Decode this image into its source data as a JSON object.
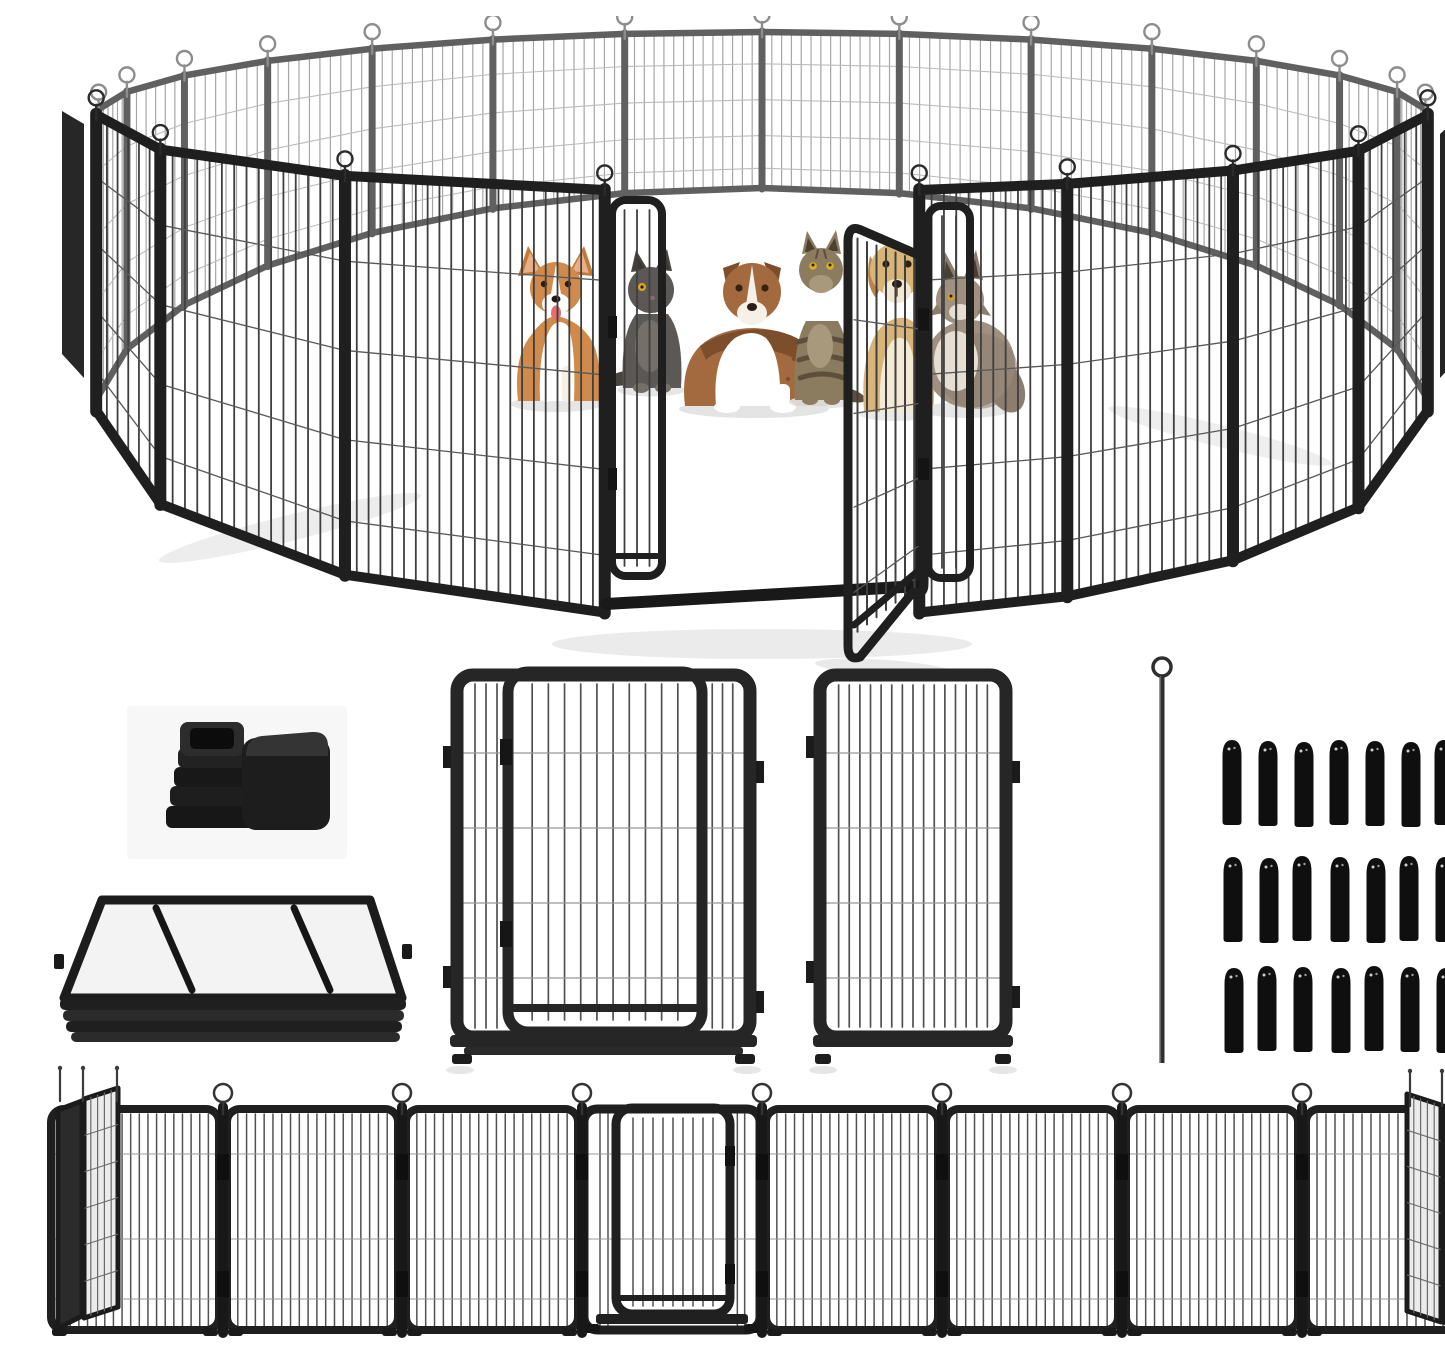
{
  "meta": {
    "title": "Heavy-duty black metal pet playpen kit product photo",
    "description": "Circular arrangement of wire fence panels with open double gate containing two dogs and cats; below: plastic corner caps, folded panel stack, gate panel, plain panel, ground anchor rod, 21 rubber foot caps, and an unfolded row of panels.",
    "background": "#ffffff",
    "canvas": {
      "width": 1445,
      "height": 1323
    }
  },
  "palette": {
    "front_frame": "#1f1f1f",
    "front_wire": "#3f3f3f",
    "front_hwire": "#585858",
    "front_pin": "#2b2b2b",
    "back_frame": "#606060",
    "back_wire": "#a6a6a6",
    "back_hwire": "#bcbcbc",
    "back_pin": "#8d8d8d",
    "part_frame": "#262626",
    "part_wire": "#515151",
    "part_hwire": "#989898",
    "rubber": "#0f0f0f",
    "shadow": "#e3e3e3",
    "card": "#f7f7f7",
    "side_fill_left": "#272727",
    "side_fill_right": "#242424",
    "angled_light_fill": "#ebebeb",
    "angled_dark_fill": "#2b2b2b",
    "grid_line": "#6a6a6a"
  },
  "hero": {
    "ring": {
      "cx": 722,
      "rx": 665,
      "rxDepth": 35,
      "topC": 92,
      "topA": 80,
      "botC": 390,
      "botA": 215,
      "hFr": [
        0.22,
        0.44,
        0.66,
        0.86
      ],
      "backFrom": 92,
      "backTo": 268,
      "backPanels": 14,
      "frontLeft": [
        -88,
        -62,
        -37,
        -13
      ],
      "frontRight": [
        13,
        26,
        43,
        61,
        88
      ],
      "edgeQuadLeft": [
        [
          22,
          95
        ],
        [
          44,
          108
        ],
        [
          44,
          362
        ],
        [
          22,
          338
        ]
      ],
      "edgeQuadRight": [
        [
          1400,
          118
        ],
        [
          1422,
          98
        ],
        [
          1422,
          338
        ],
        [
          1400,
          362
        ]
      ]
    },
    "gate": {
      "leftLeaf": {
        "x1": 572,
        "x2": 622,
        "yT": 184,
        "yB": 560,
        "bars": 3
      },
      "jamb": {
        "x1": 888,
        "x2": 930,
        "yT": 190,
        "yB": 562,
        "bars": 2
      },
      "threshold": {
        "x1": 566,
        "y1": 588,
        "x2": 880,
        "y2": 570,
        "w": 12
      },
      "door": {
        "fx": 808,
        "fyT": 210,
        "fyB": 636,
        "hx": 884,
        "hyT": 238,
        "hyB": 578,
        "bars": 7
      }
    },
    "groundShadows": [
      {
        "cx": 250,
        "cy": 512,
        "rx": 135,
        "ry": 13,
        "rot": -14,
        "o": 0.65
      },
      {
        "cx": 722,
        "cy": 628,
        "rx": 210,
        "ry": 15,
        "rot": 0,
        "o": 0.7
      },
      {
        "cx": 1180,
        "cy": 420,
        "rx": 115,
        "ry": 11,
        "rot": 14,
        "o": 0.6
      },
      {
        "cx": 845,
        "cy": 652,
        "rx": 70,
        "ry": 8,
        "rot": 4,
        "o": 0.8
      }
    ]
  },
  "animals": [
    {
      "id": "corgi",
      "label": "corgi dog sitting",
      "cx": 517,
      "baseY": 388,
      "colors": {
        "coat": "#cf8a4c",
        "coatDark": "#c07a3a",
        "earInner": "#e8b088",
        "white": "#ffffff",
        "tongue": "#e4706e",
        "eye": "#2b1d12"
      }
    },
    {
      "id": "gray_cat",
      "label": "gray cat sitting",
      "cx": 611,
      "baseY": 374,
      "colors": {
        "coat": "#5c5855",
        "coatDark": "#48443f",
        "chest": "#747069",
        "eye": "#dfa71f",
        "earInner": "#3b3734"
      }
    },
    {
      "id": "aussie",
      "label": "australian shepherd lying",
      "cx": 714,
      "baseY": 393,
      "colors": {
        "coat": "#a26a3e",
        "coatDark": "#7c4e2c",
        "white": "#ffffff",
        "muzzle": "#f6f0e7",
        "eye": "#35230f"
      }
    },
    {
      "id": "tabby_cat",
      "label": "tabby cat looking up",
      "cx": 782,
      "baseY": 386,
      "colors": {
        "coat": "#8c7c5f",
        "stripe": "#5d4f3c",
        "chest": "#a8997c",
        "eye": "#d8b01f",
        "earInner": "#4e4030"
      }
    },
    {
      "id": "golden_dog",
      "label": "golden dog behind gate",
      "cx": 857,
      "baseY": 398,
      "colors": {
        "coat": "#d9b478",
        "ear": "#b9854b",
        "chest": "#f3e9d4",
        "muzzle": "#f2e7d2",
        "eye": "#2e2013"
      }
    },
    {
      "id": "fluffy_cat",
      "label": "long-haired cat sitting",
      "cx": 926,
      "baseY": 394,
      "colors": {
        "coat": "#a09082",
        "fluff": "#8d7d6f",
        "chest": "#e7ded3",
        "eye": "#cb9d2a",
        "earInner": "#4a3f35"
      }
    }
  ],
  "parts": {
    "caps_card": {
      "x": 87,
      "y": 690,
      "w": 220,
      "h": 153,
      "items": [
        "ribbed square tube insert",
        "square corner cover cap"
      ],
      "rib_layers": 4
    },
    "folded_stack": {
      "topFace": [
        [
          62,
          884
        ],
        [
          330,
          884
        ],
        [
          362,
          982
        ],
        [
          24,
          982
        ]
      ],
      "layers": [
        [
          20,
          982,
          346,
          12
        ],
        [
          23,
          994,
          341,
          11
        ],
        [
          26,
          1005,
          336,
          11
        ],
        [
          31,
          1016,
          329,
          10
        ]
      ],
      "depthLines": 16,
      "crossLines": 5,
      "braces": [
        [
          116,
          892,
          152,
          974
        ],
        [
          254,
          892,
          290,
          974
        ]
      ]
    },
    "door_panel": {
      "x1": 410,
      "x2": 717,
      "yT": 652,
      "yB": 1048,
      "frame": {
        "x": 417,
        "y": 659,
        "w": 293,
        "h": 362
      },
      "door": {
        "x": 468,
        "y": 656,
        "w": 194,
        "h": 360,
        "bars": 10
      },
      "leftStripBars": 3,
      "rightStripBars": 3,
      "hwireY": [
        737,
        812,
        887,
        962
      ]
    },
    "plain_panel": {
      "frame": {
        "x": 780,
        "y": 659,
        "w": 186,
        "h": 362
      },
      "bars": 15,
      "hwireY": [
        737,
        812,
        887,
        962
      ]
    },
    "anchor_rod": {
      "x": 1122,
      "loopY": 651,
      "loopR": 9,
      "y1": 660,
      "y2": 1047,
      "w": 5
    },
    "rubber_caps": {
      "rows": 3,
      "columns": 7,
      "total": 21,
      "colX": [
        1193,
        1228,
        1263,
        1300,
        1335,
        1370,
        1405
      ],
      "rowY": [
        725,
        841,
        951
      ],
      "capW": 19,
      "capH": 82
    }
  },
  "bottom_row": {
    "yT": 1089,
    "yB": 1318,
    "junctions": [
      183,
      362,
      542,
      722,
      902,
      1082,
      1262
    ],
    "flatPanels": [
      [
        7,
        183
      ],
      [
        183,
        362
      ],
      [
        362,
        542
      ],
      [
        722,
        902
      ],
      [
        902,
        1082
      ],
      [
        1082,
        1262
      ],
      [
        1262,
        1436
      ]
    ],
    "doorPanel": {
      "x1": 542,
      "x2": 722,
      "door": {
        "x": 576,
        "y": 1092,
        "w": 114,
        "h": 206,
        "bars": 9
      }
    },
    "hwireY": [
      1138,
      1223,
      1283
    ],
    "angledLeft": {
      "dark": [
        [
          18,
          1094
        ],
        [
          42,
          1085
        ],
        [
          42,
          1300
        ],
        [
          18,
          1312
        ]
      ],
      "light": [
        [
          44,
          1083
        ],
        [
          78,
          1072
        ],
        [
          78,
          1291
        ],
        [
          44,
          1302
        ]
      ],
      "pinsX": [
        20,
        43,
        77
      ]
    },
    "angledRight": {
      "light": [
        [
          1367,
          1078
        ],
        [
          1401,
          1089
        ],
        [
          1401,
          1306
        ],
        [
          1367,
          1295
        ]
      ],
      "dark": [
        [
          1403,
          1090
        ],
        [
          1437,
          1101
        ],
        [
          1437,
          1317
        ],
        [
          1403,
          1306
        ]
      ],
      "pinsX": [
        1370,
        1402,
        1437
      ]
    }
  }
}
